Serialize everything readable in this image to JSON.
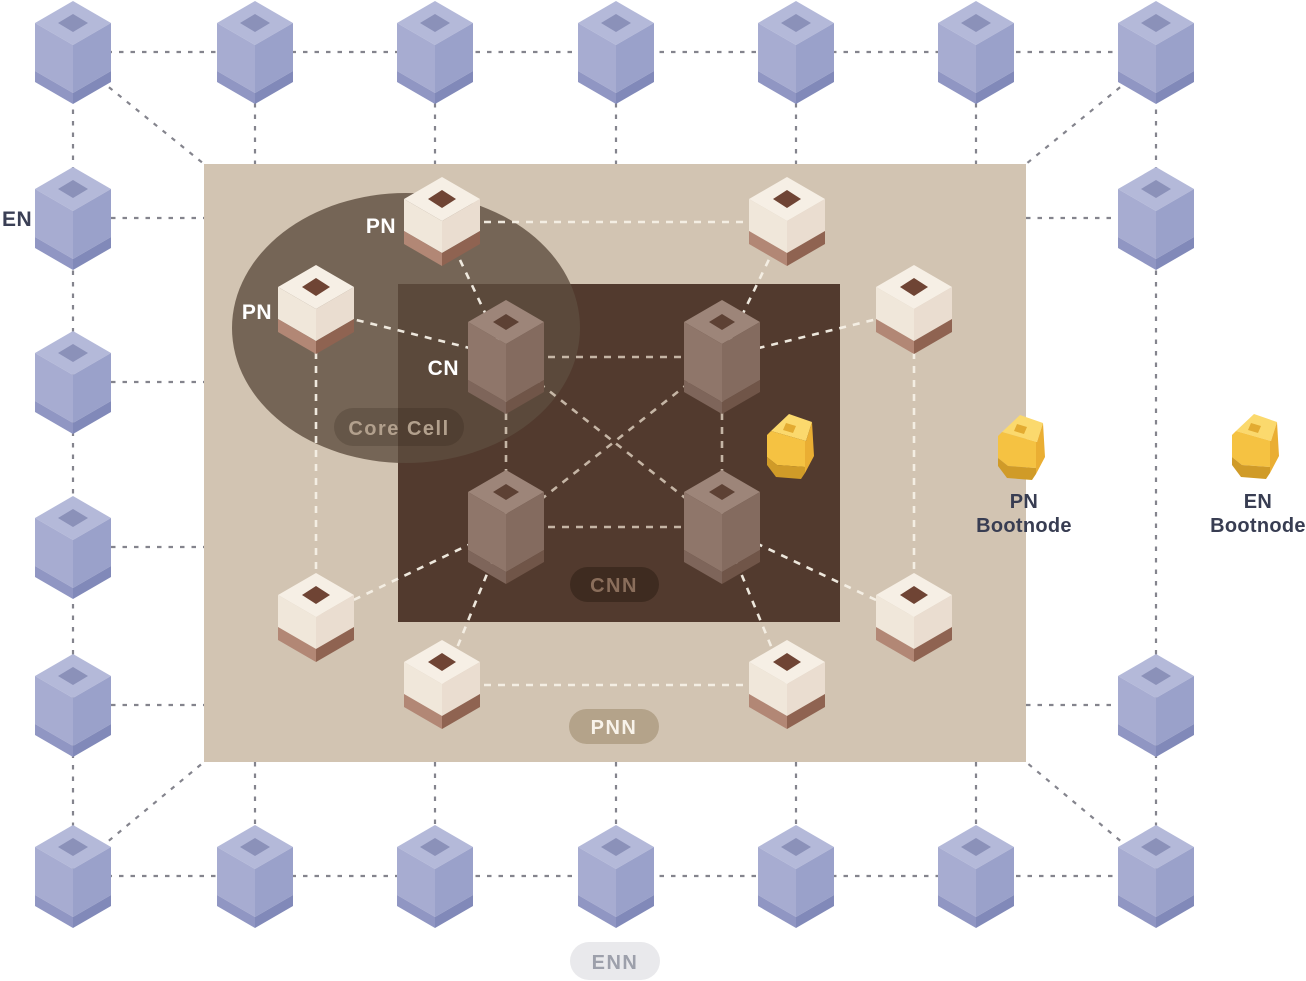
{
  "diagram": {
    "labels": {
      "en": "EN",
      "pn_top": "PN",
      "pn_left": "PN",
      "cn": "CN",
      "pn_bootnode_line1": "PN",
      "pn_bootnode_line2": "Bootnode",
      "en_bootnode_line1": "EN",
      "en_bootnode_line2": "Bootnode"
    },
    "badges": {
      "core_cell": "Core Cell",
      "cnn": "CNN",
      "pnn": "PNN",
      "enn": "ENN"
    },
    "colors": {
      "page_bg": "#ffffff",
      "pnn_region": "#d2c4b2",
      "cnn_region": "#523a2e",
      "core_cell_overlay": "#5e4d3e",
      "en_node": "#a7acd1",
      "pn_node": "#f0e7da",
      "cn_node": "#8f766a",
      "bootnode": "#f5c242",
      "en_edge": "#84848d",
      "pn_edge": "#f6f0e6",
      "cn_edge": "#e2d5c3",
      "dark_label": "#3a3f55",
      "light_label": "#ffffff",
      "cnn_badge_bg": "#3e2b20",
      "cnn_badge_text": "#8a6e5b",
      "pnn_badge_bg": "#b4a38a",
      "pnn_badge_text": "#f8f3ea",
      "enn_badge_bg": "#e9e9ec",
      "enn_badge_text": "#9da0ab",
      "core_badge_text": "#b2a08d"
    },
    "nodes": {
      "en": [
        [
          73,
          52
        ],
        [
          255,
          52
        ],
        [
          435,
          52
        ],
        [
          616,
          52
        ],
        [
          796,
          52
        ],
        [
          976,
          52
        ],
        [
          1156,
          52
        ],
        [
          73,
          218
        ],
        [
          73,
          382
        ],
        [
          73,
          547
        ],
        [
          73,
          705
        ],
        [
          1156,
          218
        ],
        [
          1156,
          705
        ],
        [
          73,
          876
        ],
        [
          255,
          876
        ],
        [
          435,
          876
        ],
        [
          616,
          876
        ],
        [
          796,
          876
        ],
        [
          976,
          876
        ],
        [
          1156,
          876
        ]
      ],
      "pn": [
        [
          442,
          222
        ],
        [
          787,
          222
        ],
        [
          316,
          310
        ],
        [
          914,
          310
        ],
        [
          316,
          618
        ],
        [
          914,
          618
        ],
        [
          442,
          685
        ],
        [
          787,
          685
        ]
      ],
      "cn": [
        [
          506,
          357
        ],
        [
          722,
          357
        ],
        [
          506,
          527
        ],
        [
          722,
          527
        ]
      ],
      "bootnodes": [
        [
          763,
          413
        ],
        [
          994,
          414
        ],
        [
          1228,
          413
        ]
      ]
    },
    "edges": {
      "en": [
        [
          73,
          52,
          1156,
          52
        ],
        [
          73,
          876,
          1156,
          876
        ],
        [
          73,
          52,
          73,
          876
        ],
        [
          1156,
          52,
          1156,
          876
        ],
        [
          111,
          218,
          204,
          218
        ],
        [
          111,
          382,
          204,
          382
        ],
        [
          111,
          547,
          204,
          547
        ],
        [
          111,
          705,
          204,
          705
        ],
        [
          1026,
          218,
          1118,
          218
        ],
        [
          1026,
          705,
          1118,
          705
        ],
        [
          255,
          103,
          255,
          164
        ],
        [
          435,
          103,
          435,
          164
        ],
        [
          616,
          103,
          616,
          164
        ],
        [
          796,
          103,
          796,
          164
        ],
        [
          976,
          103,
          976,
          164
        ],
        [
          255,
          762,
          255,
          825
        ],
        [
          435,
          762,
          435,
          825
        ],
        [
          616,
          762,
          616,
          825
        ],
        [
          796,
          762,
          796,
          825
        ],
        [
          976,
          762,
          976,
          825
        ],
        [
          100,
          80,
          204,
          164
        ],
        [
          1129,
          80,
          1026,
          164
        ],
        [
          100,
          848,
          204,
          762
        ],
        [
          1129,
          848,
          1026,
          762
        ]
      ],
      "pn": [
        [
          442,
          222,
          787,
          222
        ],
        [
          442,
          685,
          787,
          685
        ],
        [
          316,
          310,
          316,
          618
        ],
        [
          914,
          310,
          914,
          618
        ],
        [
          442,
          222,
          506,
          357
        ],
        [
          316,
          310,
          506,
          357
        ],
        [
          787,
          222,
          722,
          357
        ],
        [
          914,
          310,
          722,
          357
        ],
        [
          316,
          618,
          506,
          527
        ],
        [
          442,
          685,
          506,
          527
        ],
        [
          914,
          618,
          722,
          527
        ],
        [
          787,
          685,
          722,
          527
        ]
      ],
      "cn": [
        [
          506,
          357,
          722,
          357
        ],
        [
          506,
          527,
          722,
          527
        ],
        [
          506,
          357,
          506,
          527
        ],
        [
          722,
          357,
          722,
          527
        ],
        [
          506,
          357,
          722,
          527
        ],
        [
          722,
          357,
          506,
          527
        ]
      ]
    }
  }
}
